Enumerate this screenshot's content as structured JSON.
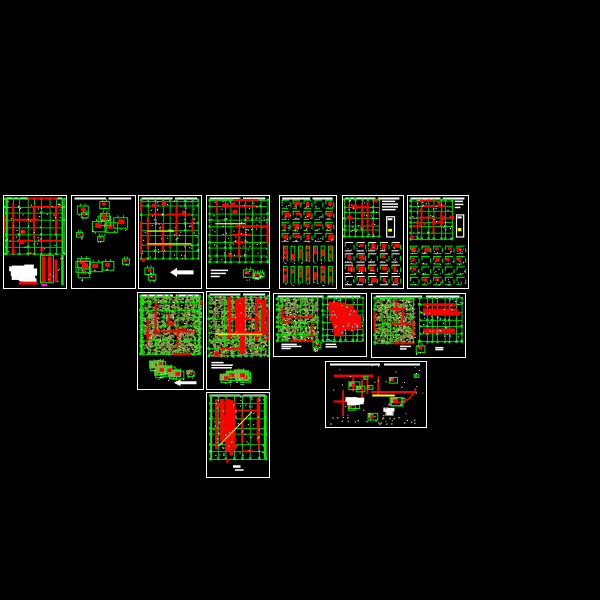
{
  "app": {
    "kind": "cad-drawing-set-preview",
    "background": "#000000",
    "sheet_count": 13
  },
  "palette": {
    "green": "#00ee00",
    "red": "#f80400",
    "olive": "#a0a455",
    "dark_olive": "#6e7034",
    "yellow": "#ffff00",
    "magenta": "#ff00ff",
    "cyan": "#00ffff",
    "white": "#ffffff",
    "black": "#000000"
  },
  "sheets": [
    {
      "name": "sheet-foundation-plan",
      "x": 3,
      "y": 195,
      "w": 64,
      "h": 94,
      "seed": 11,
      "regions": [
        {
          "t": "plan",
          "x": 0.03,
          "y": 0.03,
          "w": 0.93,
          "h": 0.6,
          "nv": 8,
          "nh": 8,
          "rh": "mix",
          "segs": 12,
          "blocks": 6,
          "wn": 45,
          "edge": true
        },
        {
          "t": "blobs",
          "x": 0.03,
          "y": 0.66,
          "w": 0.5,
          "h": 0.3,
          "n": 3
        },
        {
          "t": "bars",
          "x": 0.58,
          "y": 0.64,
          "w": 0.38,
          "h": 0.33
        }
      ]
    },
    {
      "name": "sheet-beam-details",
      "x": 71,
      "y": 195,
      "w": 65,
      "h": 94,
      "seed": 22,
      "regions": [
        {
          "t": "scatter",
          "x": 0.03,
          "y": 0.04,
          "w": 0.94,
          "h": 0.92,
          "n": 16,
          "s": 10
        }
      ]
    },
    {
      "name": "sheet-floor-plan-1",
      "x": 138,
      "y": 195,
      "w": 64,
      "h": 94,
      "seed": 33,
      "regions": [
        {
          "t": "plan",
          "x": 0.04,
          "y": 0.04,
          "w": 0.92,
          "h": 0.64,
          "nv": 8,
          "nh": 8,
          "rh": "mix",
          "segs": 9,
          "blocks": 5,
          "wn": 40,
          "yellow": 2,
          "oliveSpeck": true
        },
        {
          "t": "scatter",
          "x": 0.05,
          "y": 0.74,
          "w": 0.3,
          "h": 0.2,
          "n": 2,
          "s": 8
        },
        {
          "t": "arrow",
          "x": 0.5,
          "y": 0.78,
          "w": 0.38,
          "h": 0.1
        }
      ]
    },
    {
      "name": "sheet-floor-plan-2",
      "x": 206,
      "y": 195,
      "w": 64,
      "h": 94,
      "seed": 44,
      "regions": [
        {
          "t": "plan",
          "x": 0.04,
          "y": 0.04,
          "w": 0.92,
          "h": 0.68,
          "nv": 8,
          "nh": 9,
          "rh": "mix",
          "segs": 10,
          "blocks": 6,
          "wn": 45,
          "yellow": 1,
          "oliveSpeck": true
        },
        {
          "t": "whitelines",
          "x": 0.06,
          "y": 0.8,
          "w": 0.3,
          "h": 0.1,
          "n": 3
        },
        {
          "t": "scatter",
          "x": 0.45,
          "y": 0.78,
          "w": 0.5,
          "h": 0.16,
          "n": 4,
          "s": 7,
          "colorful": true
        }
      ]
    },
    {
      "name": "sheet-column-details",
      "x": 279,
      "y": 195,
      "w": 58,
      "h": 94,
      "seed": 55,
      "regions": [
        {
          "t": "cells",
          "x": 0.03,
          "y": 0.04,
          "w": 0.94,
          "h": 0.46,
          "rows": 4,
          "cols": 5,
          "frame": "green",
          "red": 0.75
        },
        {
          "t": "strips",
          "x": 0.03,
          "y": 0.54,
          "w": 0.94,
          "h": 0.19,
          "cols": 7
        },
        {
          "t": "strips",
          "x": 0.03,
          "y": 0.76,
          "w": 0.94,
          "h": 0.21,
          "cols": 7
        }
      ]
    },
    {
      "name": "sheet-plan-with-details-1",
      "x": 342,
      "y": 195,
      "w": 62,
      "h": 94,
      "seed": 66,
      "regions": [
        {
          "t": "plan",
          "x": 0.03,
          "y": 0.04,
          "w": 0.58,
          "h": 0.4,
          "nv": 6,
          "nh": 6,
          "rh": "mix",
          "segs": 8,
          "blocks": 5,
          "wn": 25
        },
        {
          "t": "whitelines",
          "x": 0.65,
          "y": 0.05,
          "w": 0.32,
          "h": 0.12,
          "n": 4
        },
        {
          "t": "capsule",
          "x": 0.72,
          "y": 0.22,
          "w": 0.13,
          "h": 0.22
        },
        {
          "t": "cells",
          "x": 0.03,
          "y": 0.5,
          "w": 0.94,
          "h": 0.47,
          "rows": 4,
          "cols": 5,
          "frame": "white",
          "red": 0.8
        }
      ]
    },
    {
      "name": "sheet-plan-with-details-2",
      "x": 407,
      "y": 195,
      "w": 62,
      "h": 94,
      "seed": 77,
      "regions": [
        {
          "t": "plan",
          "x": 0.04,
          "y": 0.04,
          "w": 0.7,
          "h": 0.42,
          "nv": 7,
          "nh": 7,
          "rh": "mix",
          "segs": 9,
          "blocks": 6,
          "wn": 30
        },
        {
          "t": "whitelines",
          "x": 0.78,
          "y": 0.05,
          "w": 0.19,
          "h": 0.1,
          "n": 3
        },
        {
          "t": "capsule",
          "x": 0.8,
          "y": 0.2,
          "w": 0.12,
          "h": 0.24
        },
        {
          "t": "cells",
          "x": 0.03,
          "y": 0.54,
          "w": 0.94,
          "h": 0.43,
          "rows": 4,
          "cols": 5,
          "frame": "green",
          "red": 0.6
        }
      ]
    },
    {
      "name": "sheet-slab-plan-1",
      "x": 137,
      "y": 292,
      "w": 67,
      "h": 98,
      "seed": 88,
      "regions": [
        {
          "t": "plan",
          "x": 0.04,
          "y": 0.03,
          "w": 0.92,
          "h": 0.6,
          "nv": 8,
          "nh": 8,
          "rh": "mix",
          "segs": 8,
          "blocks": 4,
          "wn": 40,
          "olive": true,
          "magenta": true,
          "edge": true
        },
        {
          "t": "scatter",
          "x": 0.03,
          "y": 0.68,
          "w": 0.94,
          "h": 0.24,
          "n": 10,
          "s": 9,
          "olive": true
        },
        {
          "t": "arrow",
          "x": 0.55,
          "y": 0.9,
          "w": 0.35,
          "h": 0.07
        }
      ]
    },
    {
      "name": "sheet-slab-plan-2",
      "x": 206,
      "y": 291,
      "w": 64,
      "h": 99,
      "seed": 99,
      "regions": [
        {
          "t": "plan",
          "x": 0.04,
          "y": 0.04,
          "w": 0.92,
          "h": 0.62,
          "nv": 8,
          "nh": 8,
          "rh": "v",
          "bars": 5,
          "segs": 6,
          "blocks": 4,
          "wn": 40,
          "olive": true,
          "magenta": true,
          "yellow": 1
        },
        {
          "t": "whitelines",
          "x": 0.07,
          "y": 0.72,
          "w": 0.35,
          "h": 0.08,
          "n": 3
        },
        {
          "t": "scatter",
          "x": 0.12,
          "y": 0.8,
          "w": 0.82,
          "h": 0.16,
          "n": 6,
          "s": 8,
          "olive": true
        }
      ]
    },
    {
      "name": "sheet-plan-pair-1",
      "x": 273,
      "y": 293,
      "w": 94,
      "h": 64,
      "seed": 1010,
      "regions": [
        {
          "t": "plan",
          "x": 0.03,
          "y": 0.06,
          "w": 0.44,
          "h": 0.68,
          "nv": 7,
          "nh": 7,
          "rh": "mix",
          "segs": 7,
          "olive": true,
          "wn": 30,
          "magenta": true
        },
        {
          "t": "plan",
          "x": 0.53,
          "y": 0.06,
          "w": 0.44,
          "h": 0.68,
          "nv": 7,
          "nh": 7,
          "rh": "solid",
          "wn": 20,
          "cyan": true
        },
        {
          "t": "whitelines",
          "x": 0.08,
          "y": 0.8,
          "w": 0.22,
          "h": 0.1,
          "n": 3
        },
        {
          "t": "whitelines",
          "x": 0.56,
          "y": 0.8,
          "w": 0.16,
          "h": 0.08,
          "n": 2
        },
        {
          "t": "scatter",
          "x": 0.4,
          "y": 0.76,
          "w": 0.12,
          "h": 0.2,
          "n": 2,
          "s": 6,
          "colorful": true
        }
      ]
    },
    {
      "name": "sheet-plan-pair-2",
      "x": 371,
      "y": 293,
      "w": 95,
      "h": 65,
      "seed": 1111,
      "regions": [
        {
          "t": "plan",
          "x": 0.03,
          "y": 0.06,
          "w": 0.42,
          "h": 0.7,
          "nv": 7,
          "nh": 7,
          "rh": "mix",
          "segs": 7,
          "olive": true,
          "wn": 30,
          "magenta": true
        },
        {
          "t": "plan",
          "x": 0.52,
          "y": 0.06,
          "w": 0.45,
          "h": 0.7,
          "nv": 7,
          "nh": 6,
          "rh": "h",
          "bars": 5,
          "wn": 20,
          "cyan": true
        },
        {
          "t": "whitelines",
          "x": 0.3,
          "y": 0.82,
          "w": 0.16,
          "h": 0.08,
          "n": 2
        },
        {
          "t": "whitelines",
          "x": 0.68,
          "y": 0.84,
          "w": 0.12,
          "h": 0.06,
          "n": 2
        },
        {
          "t": "scatter",
          "x": 0.47,
          "y": 0.8,
          "w": 0.1,
          "h": 0.16,
          "n": 1,
          "s": 7,
          "colorful": true
        }
      ]
    },
    {
      "name": "sheet-stair-section-details",
      "x": 325,
      "y": 361,
      "w": 102,
      "h": 67,
      "seed": 1212,
      "regions": [
        {
          "t": "section",
          "x": 0.03,
          "y": 0.05,
          "w": 0.94,
          "h": 0.9
        }
      ]
    },
    {
      "name": "sheet-roof-framing-plan",
      "x": 206,
      "y": 392,
      "w": 64,
      "h": 86,
      "seed": 1313,
      "regions": [
        {
          "t": "plan",
          "x": 0.05,
          "y": 0.04,
          "w": 0.9,
          "h": 0.74,
          "nv": 7,
          "nh": 8,
          "rh": "v",
          "bars": 7,
          "segs": 5,
          "blocks": 6,
          "wn": 35,
          "cyan": true,
          "oliveSpeck": true,
          "yellowDiag": true,
          "edge": true
        },
        {
          "t": "title",
          "x": 0.42,
          "y": 0.86,
          "w": 0.2,
          "h": 0.08
        }
      ]
    }
  ]
}
